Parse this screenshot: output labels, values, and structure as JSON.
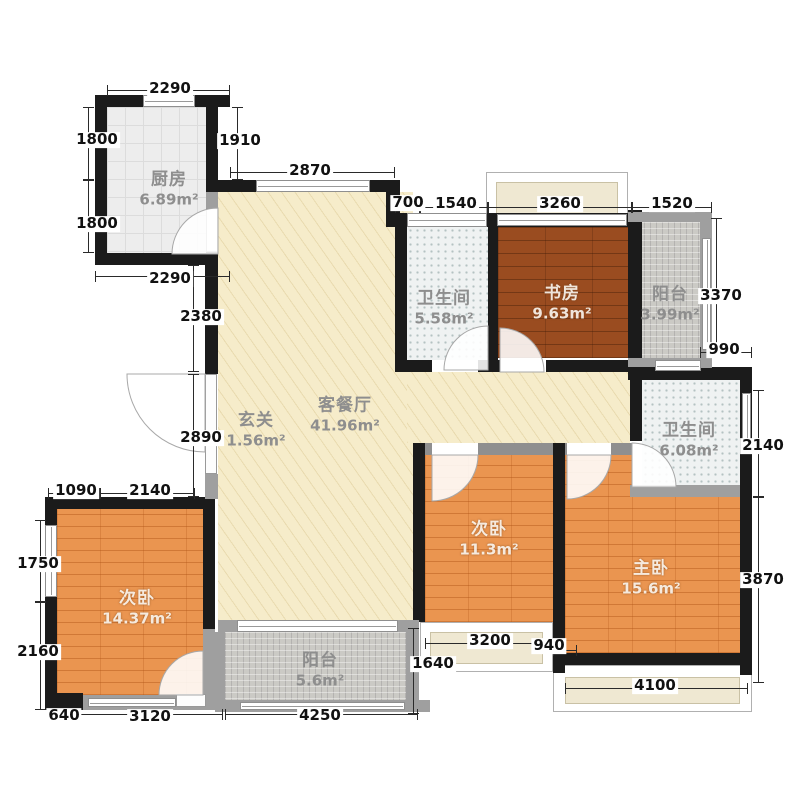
{
  "plan": {
    "rooms": [
      {
        "id": "kitchen",
        "name": "厨房",
        "area": "6.89m²"
      },
      {
        "id": "bath-top",
        "name": "卫生间",
        "area": "5.58m²"
      },
      {
        "id": "study",
        "name": "书房",
        "area": "9.63m²"
      },
      {
        "id": "balcony-top",
        "name": "阳台",
        "area": "3.99m²"
      },
      {
        "id": "entry",
        "name": "玄关",
        "area": "1.56m²"
      },
      {
        "id": "living-dining",
        "name": "客餐厅",
        "area": "41.96m²"
      },
      {
        "id": "bath-right",
        "name": "卫生间",
        "area": "6.08m²"
      },
      {
        "id": "bedroom-mid",
        "name": "次卧",
        "area": "11.3m²"
      },
      {
        "id": "master-bedroom",
        "name": "主卧",
        "area": "15.6m²"
      },
      {
        "id": "bedroom-left",
        "name": "次卧",
        "area": "14.37m²"
      },
      {
        "id": "balcony-bottom",
        "name": "阳台",
        "area": "5.6m²"
      }
    ],
    "dimensions": {
      "kitchen_top": "2290",
      "kitchen_left_upper": "1800",
      "kitchen_left_lower": "1800",
      "kitchen_right": "1910",
      "kitchen_bottom": "2290",
      "living_top": "2870",
      "top_700": "700",
      "top_1540": "1540",
      "top_3260": "3260",
      "top_1520": "1520",
      "left_2380": "2380",
      "left_2890": "2890",
      "right_3370": "3370",
      "right_990": "990",
      "right_2140": "2140",
      "right_3870": "3870",
      "bl_1090": "1090",
      "bl_2140": "2140",
      "bl_1750": "1750",
      "bl_2160": "2160",
      "bl_640": "640",
      "bl_3120": "3120",
      "bottom_4250": "4250",
      "bottom_1640": "1640",
      "bottom_3200": "3200",
      "bottom_940": "940",
      "bottom_4100": "4100"
    }
  }
}
